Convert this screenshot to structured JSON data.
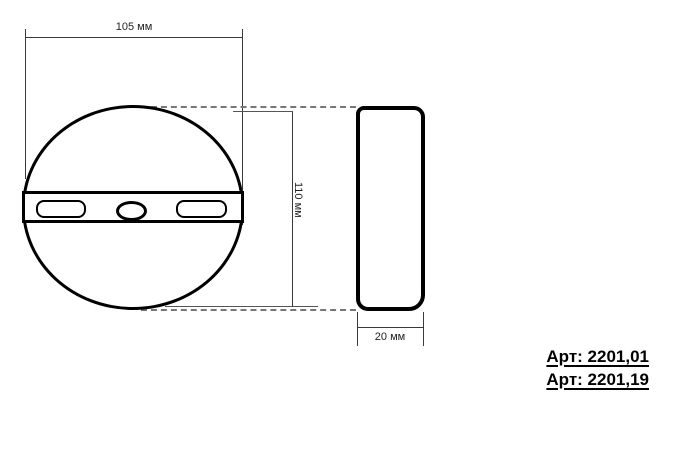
{
  "drawing": {
    "type": "technical-drawing",
    "views": {
      "front": "circular plate with mounting band, two slots and center hole",
      "side": "rounded profile 20 mm deep"
    },
    "dimensions": {
      "width": {
        "label": "105 мм",
        "value": 105,
        "unit": "мм"
      },
      "height": {
        "label": "110 мм",
        "value": 110,
        "unit": "мм"
      },
      "depth": {
        "label": "20 мм",
        "value": 20,
        "unit": "мм"
      }
    },
    "articles": [
      {
        "label": "Арт: 2201,01"
      },
      {
        "label": "Арт: 2201,19"
      }
    ],
    "colors": {
      "outline": "#000000",
      "dimension_line": "#3a3a3a",
      "dashed_line": "#777777",
      "dimension_text": "#222222",
      "article_text": "#000000",
      "background": "#ffffff"
    }
  }
}
